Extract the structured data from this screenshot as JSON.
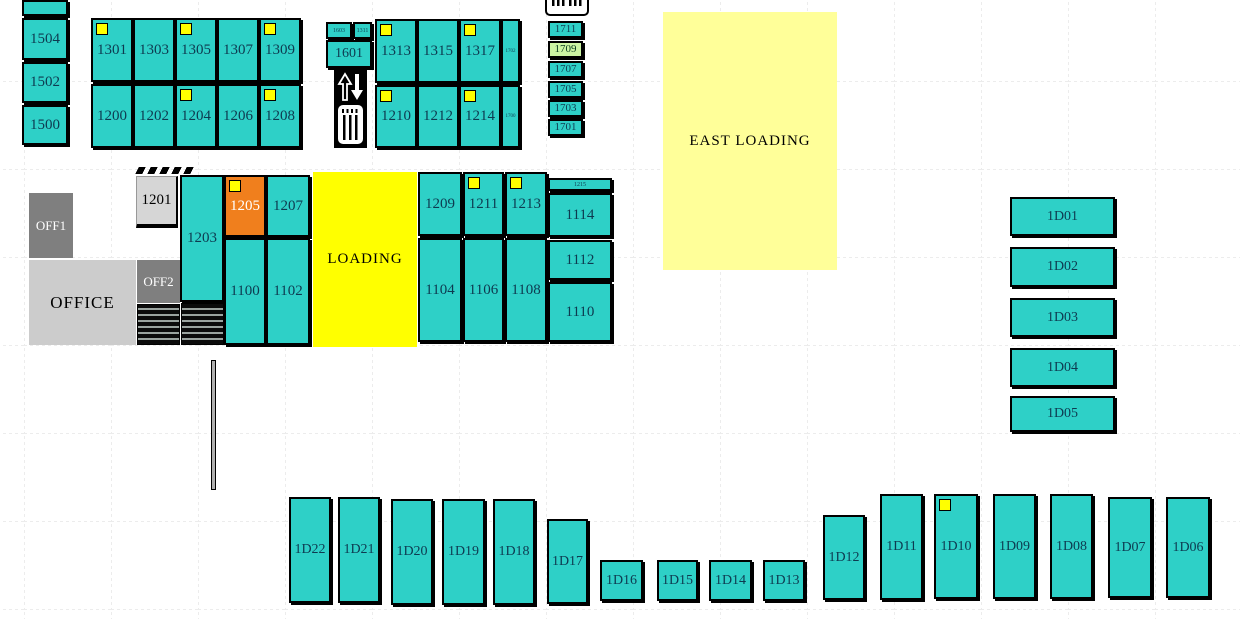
{
  "colors": {
    "teal": "#2ed0c7",
    "yellow": "#ffff00",
    "light_yellow": "#ffff99",
    "orange": "#f07f1d",
    "green": "#ccf5a3",
    "office_dark": "#7f7f7f",
    "office_light": "#cccccc"
  },
  "icons": {
    "elevator": "elevator-icon",
    "barcode": "barcode-icon"
  },
  "units": [
    {
      "label": "",
      "name": "unit-unlabeled-top",
      "x": 22,
      "y": 0,
      "w": 46,
      "h": 16
    },
    {
      "label": "1504",
      "x": 22,
      "y": 18,
      "w": 46,
      "h": 42
    },
    {
      "label": "1502",
      "x": 22,
      "y": 62,
      "w": 46,
      "h": 41
    },
    {
      "label": "1500",
      "x": 22,
      "y": 105,
      "w": 46,
      "h": 40
    },
    {
      "label": "1301",
      "x": 91,
      "y": 18,
      "w": 42,
      "h": 64,
      "ind": true
    },
    {
      "label": "1303",
      "x": 133,
      "y": 18,
      "w": 42,
      "h": 64
    },
    {
      "label": "1305",
      "x": 175,
      "y": 18,
      "w": 42,
      "h": 64,
      "ind": true
    },
    {
      "label": "1307",
      "x": 217,
      "y": 18,
      "w": 42,
      "h": 64
    },
    {
      "label": "1309",
      "x": 259,
      "y": 18,
      "w": 42,
      "h": 64,
      "ind": true
    },
    {
      "label": "1200",
      "x": 91,
      "y": 84,
      "w": 42,
      "h": 64
    },
    {
      "label": "1202",
      "x": 133,
      "y": 84,
      "w": 42,
      "h": 64
    },
    {
      "label": "1204",
      "x": 175,
      "y": 84,
      "w": 42,
      "h": 64,
      "ind": true
    },
    {
      "label": "1206",
      "x": 217,
      "y": 84,
      "w": 42,
      "h": 64
    },
    {
      "label": "1208",
      "x": 259,
      "y": 84,
      "w": 42,
      "h": 64,
      "ind": true
    },
    {
      "label": "1603",
      "x": 326,
      "y": 22,
      "w": 26,
      "h": 17,
      "kind": "tiny"
    },
    {
      "label": "1311",
      "x": 353,
      "y": 22,
      "w": 19,
      "h": 17,
      "kind": "tiny"
    },
    {
      "label": "1601",
      "x": 326,
      "y": 40,
      "w": 46,
      "h": 28,
      "fs": 14
    },
    {
      "label": "1313",
      "x": 375,
      "y": 19,
      "w": 42,
      "h": 64,
      "ind": true
    },
    {
      "label": "1315",
      "x": 417,
      "y": 19,
      "w": 42,
      "h": 64
    },
    {
      "label": "1317",
      "x": 459,
      "y": 19,
      "w": 42,
      "h": 64,
      "ind": true
    },
    {
      "label": "1702",
      "x": 501,
      "y": 19,
      "w": 19,
      "h": 64,
      "kind": "tiny",
      "fs": 5
    },
    {
      "label": "1210",
      "x": 375,
      "y": 85,
      "w": 42,
      "h": 63,
      "ind": true
    },
    {
      "label": "1212",
      "x": 417,
      "y": 85,
      "w": 42,
      "h": 63
    },
    {
      "label": "1214",
      "x": 459,
      "y": 85,
      "w": 42,
      "h": 63,
      "ind": true
    },
    {
      "label": "1700",
      "x": 501,
      "y": 85,
      "w": 19,
      "h": 63,
      "kind": "tiny",
      "fs": 5
    },
    {
      "label": "1711",
      "x": 548,
      "y": 21,
      "w": 35,
      "h": 17,
      "fs": 11
    },
    {
      "label": "1709",
      "x": 548,
      "y": 41,
      "w": 35,
      "h": 17,
      "fs": 11,
      "kind": "room-green"
    },
    {
      "label": "1707",
      "x": 548,
      "y": 61,
      "w": 35,
      "h": 17,
      "fs": 11
    },
    {
      "label": "1705",
      "x": 548,
      "y": 81,
      "w": 35,
      "h": 17,
      "fs": 11
    },
    {
      "label": "1703",
      "x": 548,
      "y": 100,
      "w": 35,
      "h": 17,
      "fs": 11
    },
    {
      "label": "1701",
      "x": 548,
      "y": 119,
      "w": 35,
      "h": 17,
      "fs": 11
    },
    {
      "label": "EAST LOADING",
      "name": "zone-east-loading",
      "x": 663,
      "y": 12,
      "w": 174,
      "h": 258,
      "kind": "zone-east",
      "click": false
    },
    {
      "label": "OFF1",
      "name": "office-off1",
      "x": 29,
      "y": 193,
      "w": 44,
      "h": 65,
      "kind": "office-dark",
      "click": false
    },
    {
      "label": "1201",
      "x": 136,
      "y": 176,
      "w": 42,
      "h": 52,
      "kind": "office-light-cell"
    },
    {
      "label": "",
      "name": "dock-ticks",
      "x": 137,
      "y": 167,
      "w": 56,
      "h": 7,
      "kind": "ticks",
      "click": false
    },
    {
      "label": "1203",
      "x": 180,
      "y": 175,
      "w": 44,
      "h": 127
    },
    {
      "label": "1205",
      "x": 224,
      "y": 175,
      "w": 42,
      "h": 62,
      "kind": "orange",
      "ind": true
    },
    {
      "label": "1207",
      "x": 266,
      "y": 175,
      "w": 44,
      "h": 62
    },
    {
      "label": "OFFICE",
      "name": "office-area",
      "x": 29,
      "y": 260,
      "w": 107,
      "h": 85,
      "kind": "office-light",
      "click": false
    },
    {
      "label": "OFF2",
      "name": "office-off2",
      "x": 137,
      "y": 260,
      "w": 43,
      "h": 43,
      "kind": "office-dark",
      "click": false
    },
    {
      "label": "",
      "name": "stairs-hatch-left",
      "x": 137,
      "y": 304,
      "w": 43,
      "h": 41,
      "kind": "hatch",
      "click": false
    },
    {
      "label": "",
      "name": "stairs-hatch-right",
      "x": 181,
      "y": 303,
      "w": 43,
      "h": 42,
      "kind": "hatch",
      "click": false
    },
    {
      "label": "1100",
      "x": 224,
      "y": 238,
      "w": 42,
      "h": 107
    },
    {
      "label": "1102",
      "x": 266,
      "y": 238,
      "w": 44,
      "h": 107
    },
    {
      "label": "LOADING",
      "name": "zone-loading",
      "x": 313,
      "y": 172,
      "w": 104,
      "h": 175,
      "kind": "zone-loading",
      "click": false
    },
    {
      "label": "1209",
      "x": 418,
      "y": 172,
      "w": 44,
      "h": 64
    },
    {
      "label": "1211",
      "x": 463,
      "y": 172,
      "w": 41,
      "h": 64,
      "ind": true
    },
    {
      "label": "1213",
      "x": 505,
      "y": 172,
      "w": 42,
      "h": 64,
      "ind": true
    },
    {
      "label": "1215",
      "x": 548,
      "y": 178,
      "w": 64,
      "h": 13,
      "kind": "tiny"
    },
    {
      "label": "1114",
      "x": 548,
      "y": 193,
      "w": 64,
      "h": 44
    },
    {
      "label": "1112",
      "x": 548,
      "y": 240,
      "w": 64,
      "h": 40
    },
    {
      "label": "1110",
      "x": 548,
      "y": 282,
      "w": 64,
      "h": 60
    },
    {
      "label": "1104",
      "x": 418,
      "y": 238,
      "w": 44,
      "h": 104
    },
    {
      "label": "1106",
      "x": 463,
      "y": 238,
      "w": 41,
      "h": 104
    },
    {
      "label": "1108",
      "x": 505,
      "y": 238,
      "w": 42,
      "h": 104
    },
    {
      "label": "",
      "name": "wall-segment",
      "x": 211,
      "y": 360,
      "w": 5,
      "h": 130,
      "kind": "wall",
      "click": false
    },
    {
      "label": "1D01",
      "x": 1010,
      "y": 197,
      "w": 105,
      "h": 39,
      "fs": 14
    },
    {
      "label": "1D02",
      "x": 1010,
      "y": 247,
      "w": 105,
      "h": 40,
      "fs": 14
    },
    {
      "label": "1D03",
      "x": 1010,
      "y": 298,
      "w": 105,
      "h": 39,
      "fs": 14
    },
    {
      "label": "1D04",
      "x": 1010,
      "y": 348,
      "w": 105,
      "h": 39,
      "fs": 14
    },
    {
      "label": "1D05",
      "x": 1010,
      "y": 396,
      "w": 105,
      "h": 36,
      "fs": 14
    },
    {
      "label": "1D22",
      "x": 289,
      "y": 497,
      "w": 42,
      "h": 106,
      "fs": 14
    },
    {
      "label": "1D21",
      "x": 338,
      "y": 497,
      "w": 42,
      "h": 106,
      "fs": 14
    },
    {
      "label": "1D20",
      "x": 391,
      "y": 499,
      "w": 42,
      "h": 106,
      "fs": 14
    },
    {
      "label": "1D19",
      "x": 442,
      "y": 499,
      "w": 43,
      "h": 106,
      "fs": 14
    },
    {
      "label": "1D18",
      "x": 493,
      "y": 499,
      "w": 42,
      "h": 106,
      "fs": 14
    },
    {
      "label": "1D17",
      "x": 547,
      "y": 519,
      "w": 41,
      "h": 85,
      "fs": 14
    },
    {
      "label": "1D16",
      "x": 600,
      "y": 560,
      "w": 43,
      "h": 41,
      "fs": 14
    },
    {
      "label": "1D15",
      "x": 657,
      "y": 560,
      "w": 41,
      "h": 41,
      "fs": 14
    },
    {
      "label": "1D14",
      "x": 709,
      "y": 560,
      "w": 43,
      "h": 41,
      "fs": 14
    },
    {
      "label": "1D13",
      "x": 763,
      "y": 560,
      "w": 42,
      "h": 41,
      "fs": 14
    },
    {
      "label": "1D12",
      "x": 823,
      "y": 515,
      "w": 42,
      "h": 85,
      "fs": 14
    },
    {
      "label": "1D11",
      "x": 880,
      "y": 494,
      "w": 43,
      "h": 106,
      "fs": 14
    },
    {
      "label": "1D10",
      "x": 934,
      "y": 494,
      "w": 44,
      "h": 105,
      "fs": 14,
      "ind": true
    },
    {
      "label": "1D09",
      "x": 993,
      "y": 494,
      "w": 43,
      "h": 105,
      "fs": 14
    },
    {
      "label": "1D08",
      "x": 1050,
      "y": 494,
      "w": 43,
      "h": 105,
      "fs": 14
    },
    {
      "label": "1D07",
      "x": 1108,
      "y": 497,
      "w": 44,
      "h": 101,
      "fs": 14
    },
    {
      "label": "1D06",
      "x": 1166,
      "y": 497,
      "w": 44,
      "h": 101,
      "fs": 14
    }
  ]
}
